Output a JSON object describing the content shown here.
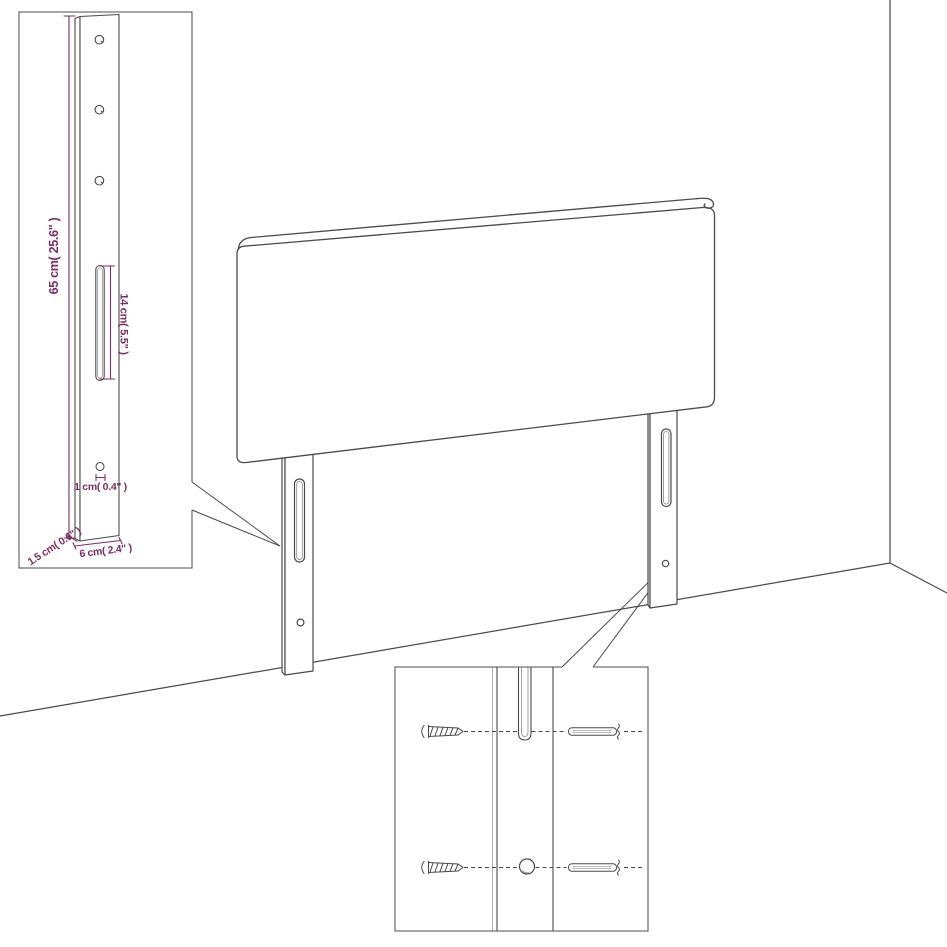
{
  "diagram": {
    "type": "product-assembly-diagram",
    "subject": "upholstered headboard with two wall-mount legs in room corner",
    "colors": {
      "background": "#ffffff",
      "line": "#4a4a4a",
      "dimension": "#7e2c64"
    },
    "leg_detail_inset": {
      "dim_height": "65 cm( 25.6\" )",
      "dim_slot": "14 cm( 5.5\" )",
      "dim_hole": "1 cm( 0.4\" )",
      "dim_width": "6 cm( 2.4\" )",
      "dim_side": "1.5 cm( 0.6\" )"
    },
    "mounting_detail_inset": {
      "parts": [
        "screw",
        "leg-slot",
        "leg-hole",
        "wall-plug"
      ]
    }
  }
}
